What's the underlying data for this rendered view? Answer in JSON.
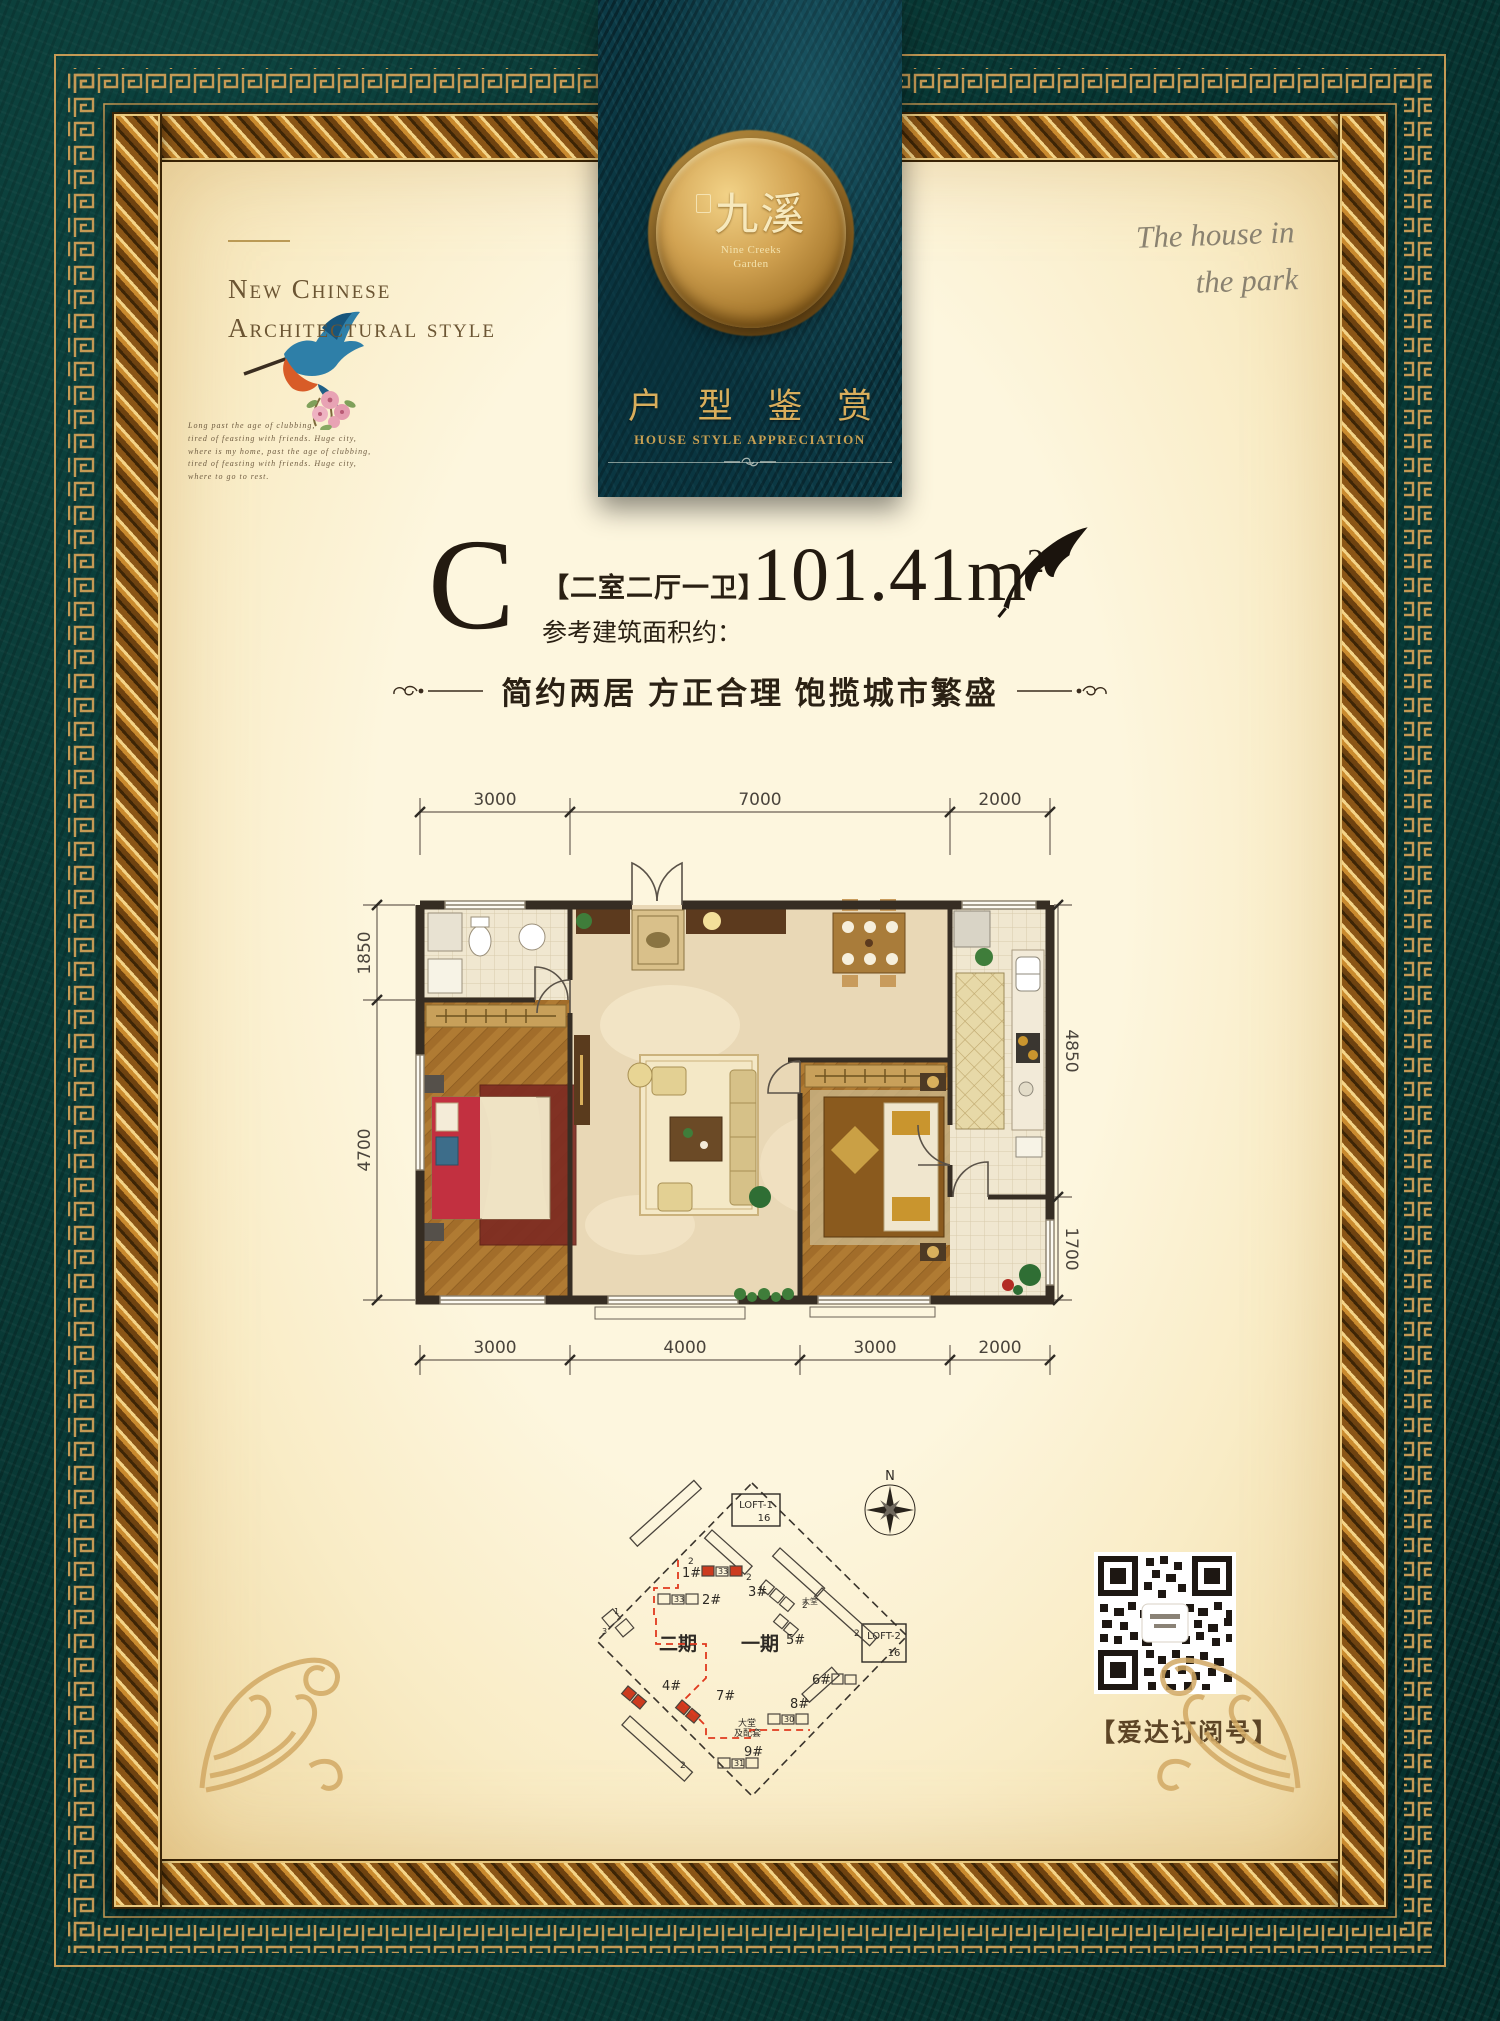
{
  "colors": {
    "teal_bg": "#07322f",
    "banner_teal": "#0c3a46",
    "gold": "#c59a55",
    "cream": "#fdf6de",
    "accent_red": "#cc3b1f"
  },
  "header": {
    "top_left": {
      "line1": "New Chinese",
      "line2": "Architectural style",
      "script_lines": [
        "Long past the age of clubbing,",
        "tired of feasting with friends. Huge city,",
        "where is my home, past the age of clubbing,",
        "tired of feasting with friends. Huge city,",
        "where to go to rest."
      ]
    },
    "top_right": {
      "line1": "The house in",
      "line2": "the park"
    },
    "banner": {
      "seal_cn": "九溪",
      "seal_en1": "Nine Creeks",
      "seal_en2": "Garden",
      "title_cn": "户 型 鉴 赏",
      "title_en": "HOUSE STYLE APPRECIATION"
    }
  },
  "unit": {
    "letter": "C",
    "layout": "【二室二厅一卫】",
    "area_label": "参考建筑面积约：",
    "area_value": "101.41m",
    "area_sup": "2",
    "tagline": "简约两居 方正合理 饱揽城市繁盛"
  },
  "floorplan": {
    "dims_top": [
      "3000",
      "7000",
      "2000"
    ],
    "dims_bottom": [
      "3000",
      "4000",
      "3000",
      "2000"
    ],
    "dims_left": [
      "1850",
      "4700"
    ],
    "dims_right": [
      "4850",
      "1700"
    ]
  },
  "siteplan": {
    "north": "N",
    "loft1_l1": "LOFT-1",
    "loft1_l2": "16",
    "loft2_l1": "LOFT-2",
    "loft2_l2": "16",
    "phase_left": "二期",
    "phase_right": "一期",
    "lobby_small": "大堂",
    "lobby_note_l1": "大堂",
    "lobby_note_l2": "及配套",
    "buildings": [
      "1#",
      "2#",
      "3#",
      "4#",
      "5#",
      "6#",
      "7#",
      "8#",
      "9#"
    ],
    "bar_label": "2",
    "count_b1": "33",
    "count_b2": "33",
    "count_b8": "30",
    "count_b9": "31",
    "count_left_a": "3",
    "count_left_b": "1"
  },
  "qr": {
    "caption": "【爱达订阅号】"
  }
}
